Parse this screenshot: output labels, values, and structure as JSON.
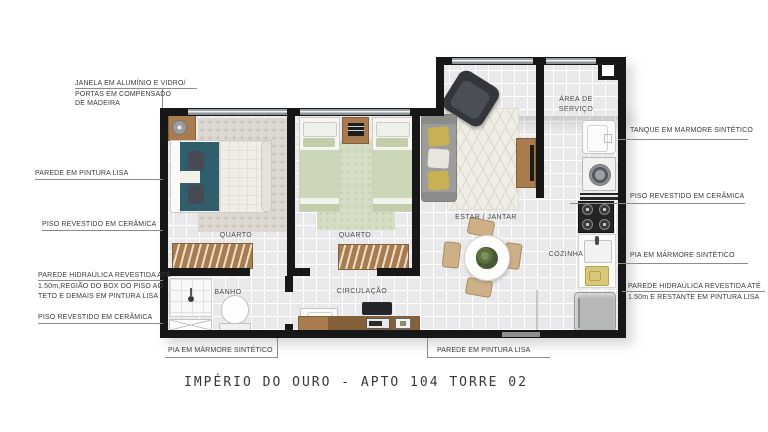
{
  "title": "IMPÉRIO DO OURO - APTO 104 TORRE 02",
  "rooms": {
    "quarto1": "QUARTO",
    "quarto2": "QUARTO",
    "banho": "BANHO",
    "circulacao": "CIRCULAÇÃO",
    "estar_jantar": "ESTAR / JANTAR",
    "cozinha": "COZINHA",
    "area_servico_line1": "ÁREA DE",
    "area_servico_line2": "SERVIÇO"
  },
  "annotations": {
    "janela_line1": "JANELA EM ALUMÍNIO E VIDRO/",
    "janela_line2": "PORTAS EM COMPENSADO",
    "janela_line3": "DE MADEIRA",
    "parede_pintura_left": "PAREDE EM PINTURA LISA",
    "piso_ceramica_left_1": "PISO REVESTIDO EM CERÂMICA",
    "hidraulica_left_line1": "PAREDE HIDRAÚLICA REVESTIDA ATÉ",
    "hidraulica_left_line2": "1.50m,REGIÃO DO BOX DO PISO AO",
    "hidraulica_left_line3": "TETO E DEMAIS EM PINTURA LISA",
    "piso_ceramica_left_2": "PISO REVESTIDO EM CERÂMICA",
    "pia_bottom": "PIA EM MÁRMORE SINTÉTICO",
    "parede_pintura_bottom": "PAREDE EM PINTURA LISA",
    "tanque_right": "TANQUE EM MARMORE SINTÉTICO",
    "piso_ceramica_right": "PISO REVESTIDO EM CERÂMICA",
    "pia_right": "PIA EM MÁRMORE SINTÉTICO",
    "hidraulica_right_line1": "PAREDE HIDRAÚLICA REVESTIDA ATÉ",
    "hidraulica_right_line2": "1.50m E RESTANTE EM PINTURA LISA"
  },
  "colors": {
    "wall": "#171717",
    "floor": "#e9e9ec",
    "wood": "#a87c4f",
    "bed_teal": "#2f5f6d",
    "bed_green": "#ccd6b8",
    "sofa_gray": "#9c9c9a"
  }
}
